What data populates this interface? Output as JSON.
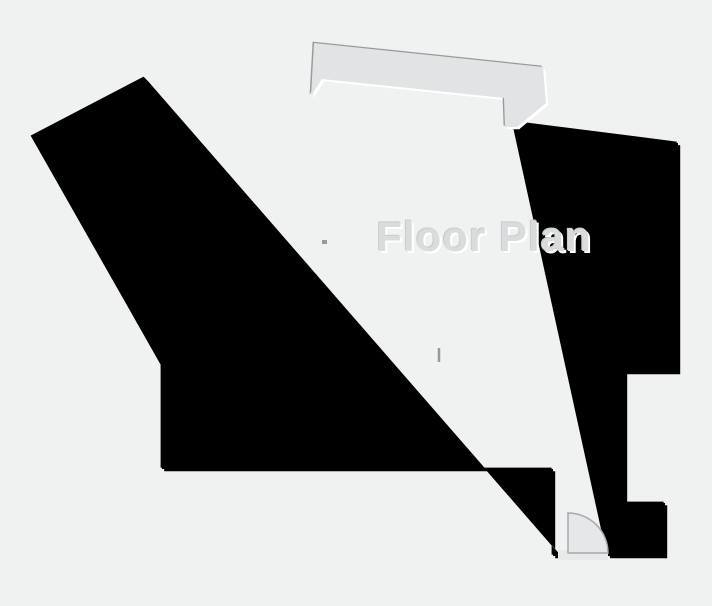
{
  "title": "Floor Plan",
  "colors": {
    "background": "#f0f1f1",
    "wall_fill": "#e1e3e4",
    "wall_shadow": "#97999b",
    "wall_highlight": "#ffffff",
    "door_fill": "#e5e7e8",
    "door_threshold": "#e8eaea",
    "door_stroke": "#a6a9ab",
    "title_color": "#d9dbdc",
    "title_shadow_dark": "#c8cbcc",
    "title_shadow_light": "#ffffff"
  },
  "bevel": {
    "highlight_offset": 2.2,
    "shadow_offset": -1.4
  }
}
